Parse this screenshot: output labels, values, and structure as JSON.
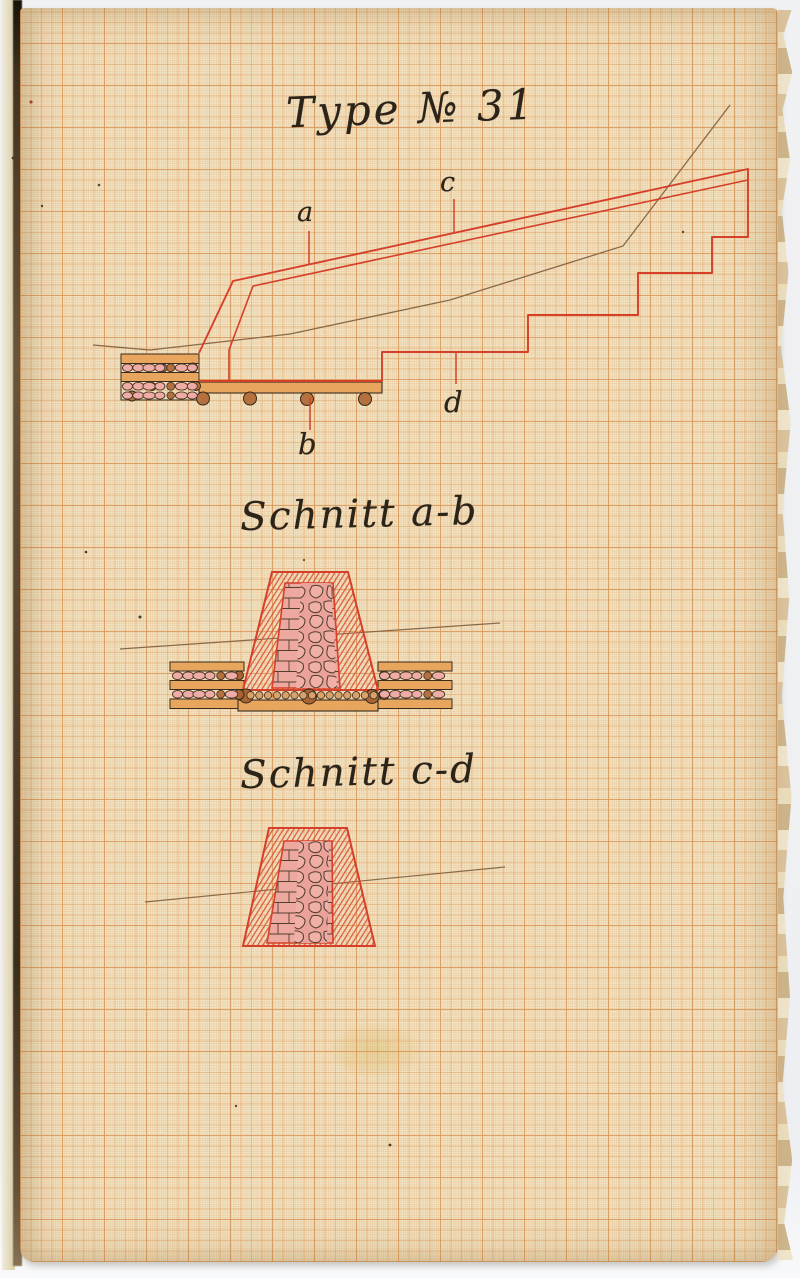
{
  "document": {
    "kind": "historical engineering drawing on millimeter graph paper",
    "title": "Type № 31",
    "profile": {
      "description": "longitudinal profile with stepped wall crest and timber grillage foundation",
      "labels": {
        "a": "a",
        "b": "b",
        "c": "c",
        "d": "d"
      }
    },
    "sections": {
      "ab": {
        "heading": "Schnitt a-b"
      },
      "cd": {
        "heading": "Schnitt c-d"
      }
    }
  },
  "colors": {
    "paper": "#f2e5c4",
    "grid_bold": "#d89a60",
    "grid_medium": "#e2ab74",
    "red_ink": "#d5402a",
    "hatch_red": "#dc5038",
    "sepia_ink": "#8a6848",
    "black_ink": "#2c2419",
    "stone_pink": "#eda89f",
    "wood_orange": "#e8a55e",
    "log_pink": "#efaca6",
    "log_brown": "#b4703e"
  }
}
